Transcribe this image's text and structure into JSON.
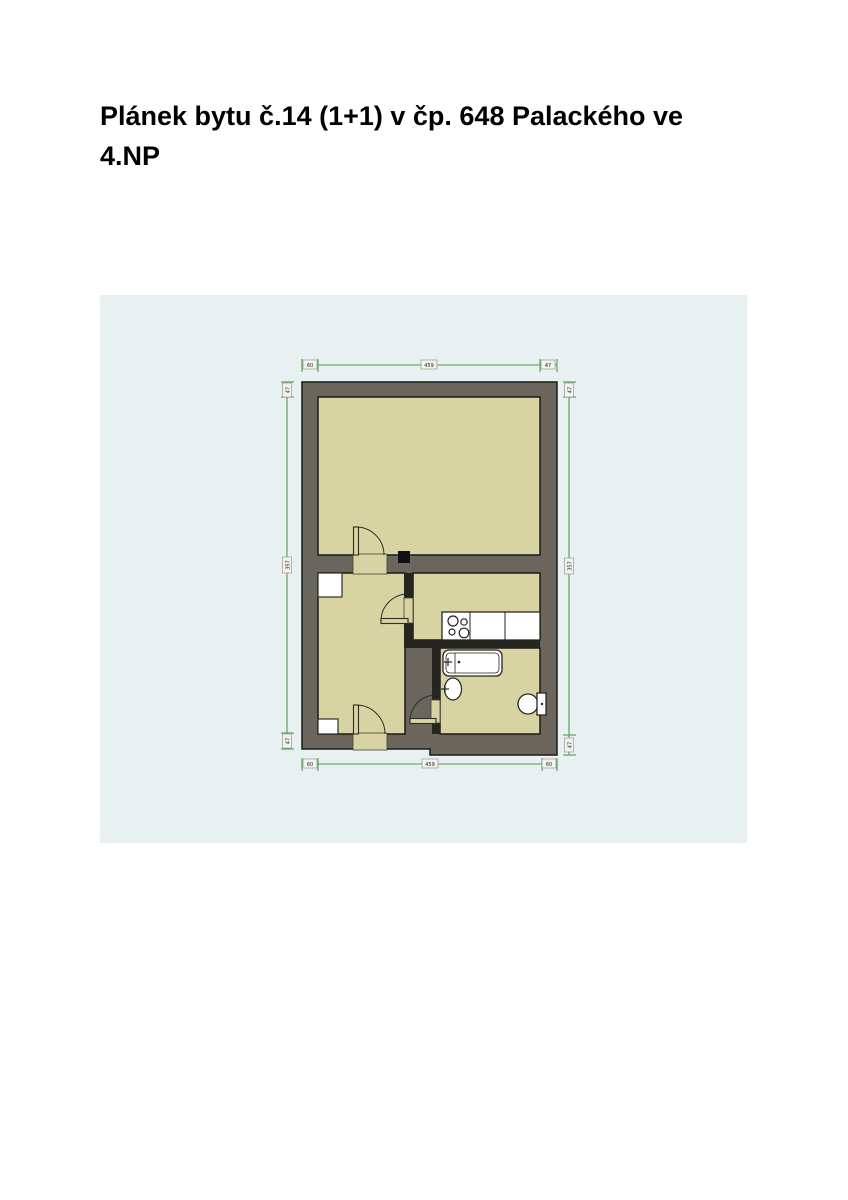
{
  "page": {
    "title": "Plánek bytu č.14 (1+1) v čp. 648 Palackého ve 4.NP"
  },
  "plan": {
    "colors": {
      "panel_background": "#e8f0f1",
      "outer_wall": "#6b665d",
      "partition": "#26251f",
      "floor": "#d8d3a2",
      "dimension_line": "#4f9d51",
      "fixture": "#ffffff",
      "flue": "#111111"
    },
    "dimensions": {
      "top": [
        "60",
        "459",
        "47"
      ],
      "bottom": [
        "60",
        "459",
        "60"
      ],
      "left": [
        "47",
        "357",
        "47"
      ],
      "right": [
        "47",
        "357",
        "47"
      ]
    }
  }
}
